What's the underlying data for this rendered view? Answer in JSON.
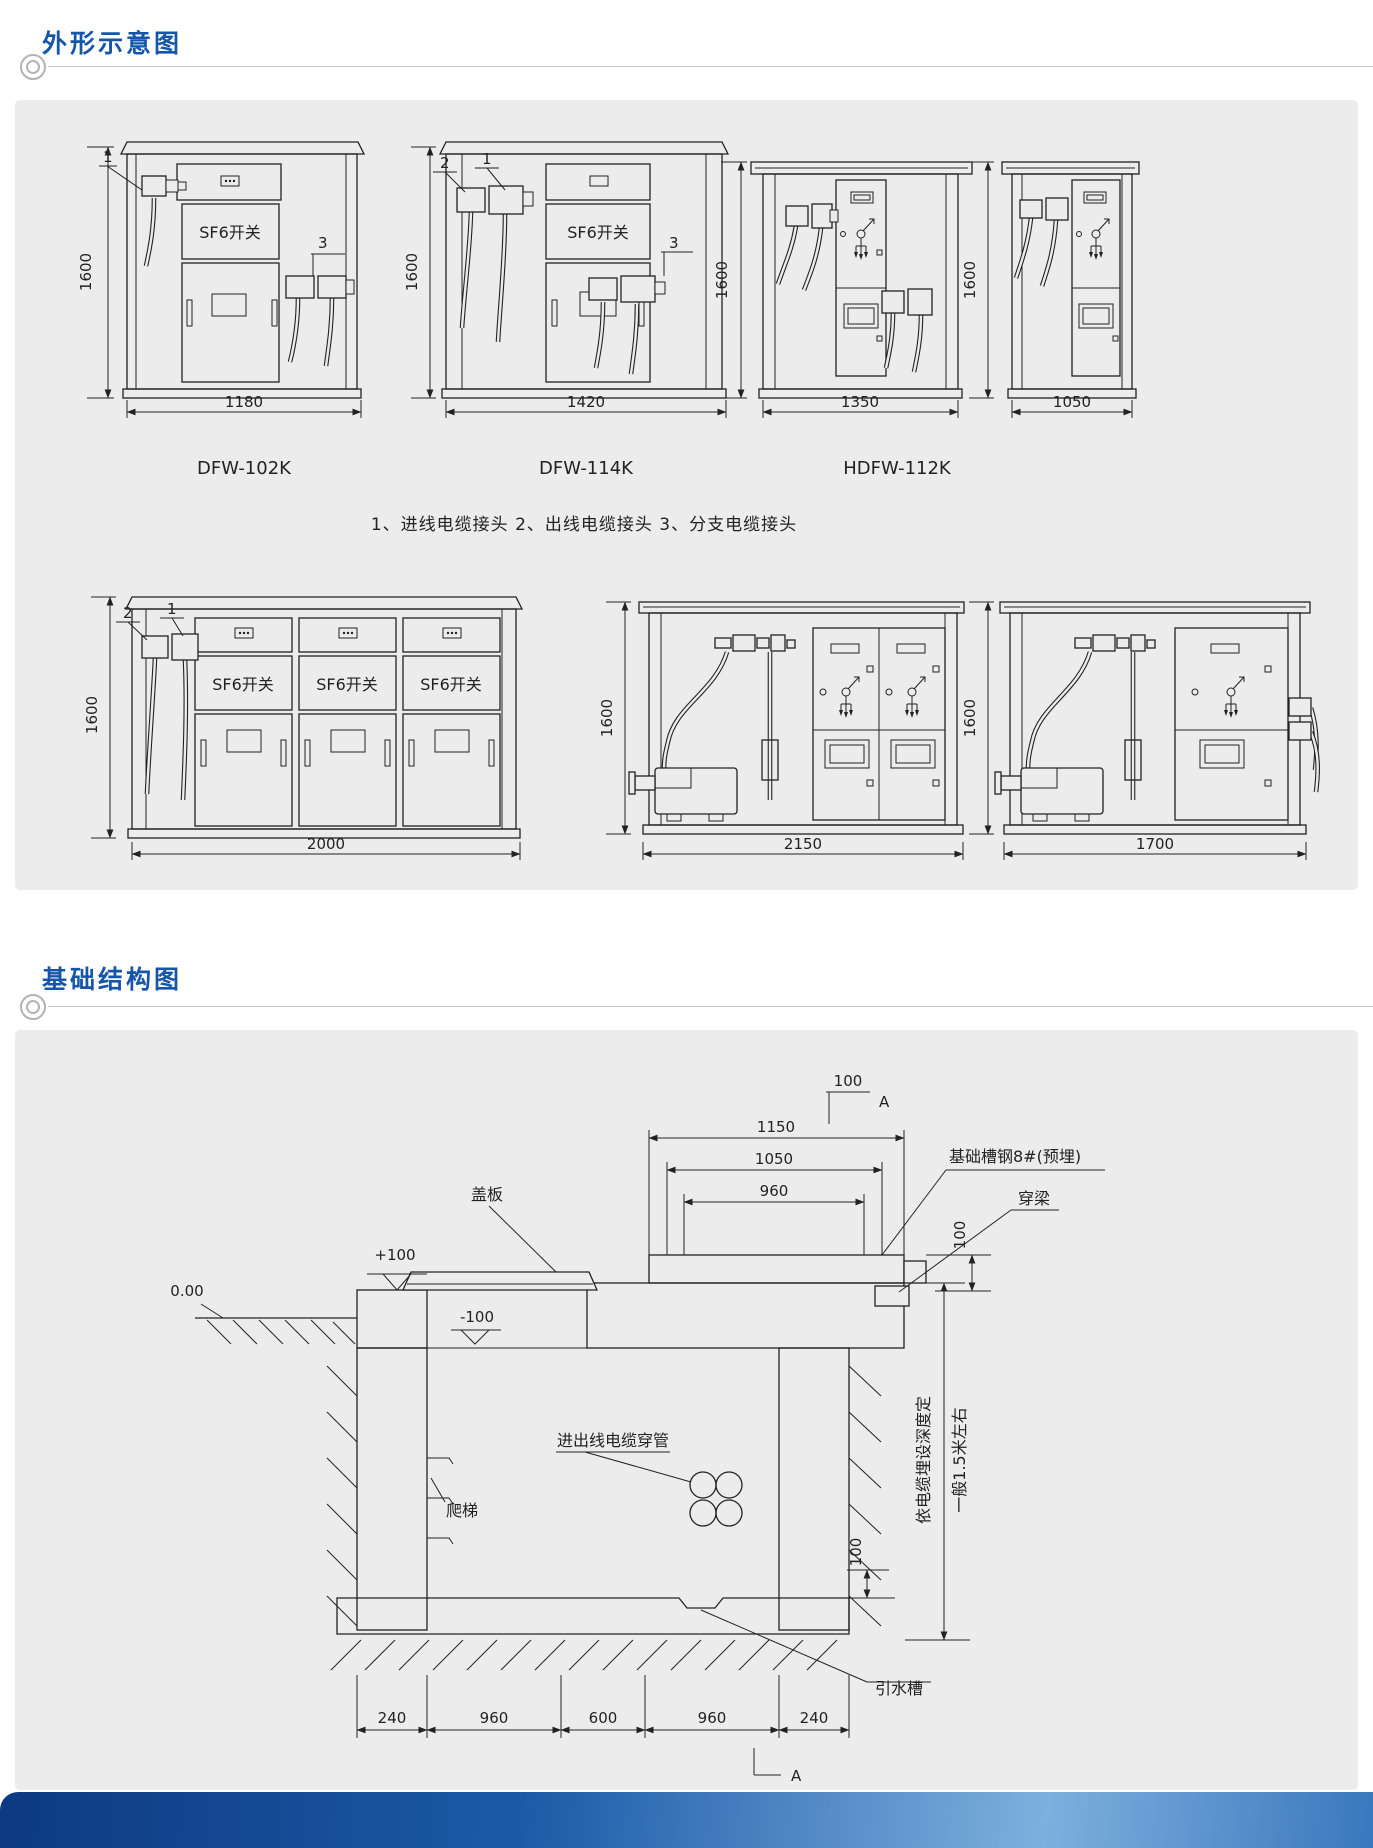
{
  "page": {
    "background": "#ffffff",
    "panel_background": "#ececec",
    "accent_blue": "#1656a8",
    "line_color": "#222222"
  },
  "sections": [
    {
      "title": "外形示意图"
    },
    {
      "title": "基础结构图"
    }
  ],
  "outline": {
    "height_dim": "1600",
    "sf6": "SF6开关",
    "callout_1": "1",
    "callout_2": "2",
    "callout_3": "3",
    "legend": "1、进线电缆接头  2、出线电缆接头  3、分支电缆接头",
    "cabinets": [
      {
        "model": "DFW-102K",
        "width_dim": "1180"
      },
      {
        "model": "DFW-114K",
        "width_dim": "1420"
      },
      {
        "model": "HDFW-112K",
        "width_dim": "1350"
      },
      {
        "model": "",
        "width_dim": "1050"
      },
      {
        "model": "",
        "width_dim": "2000"
      },
      {
        "model": "",
        "width_dim": "2150"
      },
      {
        "model": "",
        "width_dim": "1700"
      }
    ]
  },
  "foundation": {
    "section_letter": "A",
    "dims": {
      "top": [
        "1150",
        "1050",
        "960"
      ],
      "top_offset": "100",
      "beam": "100",
      "floor": "100",
      "bottom": [
        "240",
        "960",
        "600",
        "960",
        "240"
      ]
    },
    "labels": {
      "cover": "盖板",
      "channel": "基础槽钢8#(预埋)",
      "beam": "穿梁",
      "conduit": "进出线电缆穿管",
      "ladder": "爬梯",
      "drain": "引水槽",
      "depth1": "依电缆埋设深度定",
      "depth2": "一般1.5米左右",
      "lvl_plus": "+100",
      "lvl_zero": "0.00",
      "lvl_minus": "-100"
    }
  }
}
